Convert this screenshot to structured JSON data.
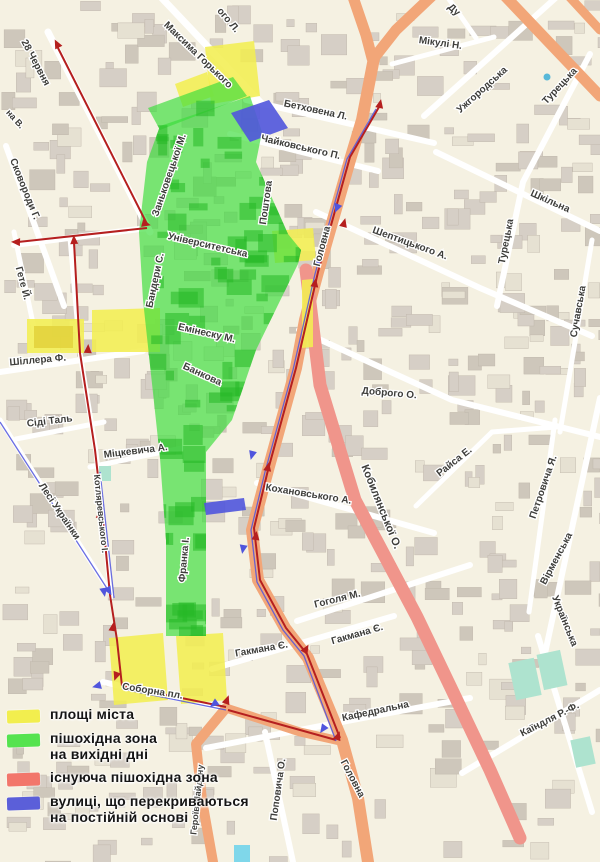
{
  "legend": {
    "items": [
      {
        "id": "city-squares",
        "color": "#f2ee4e",
        "lines": [
          "площі міста",
          ""
        ]
      },
      {
        "id": "weekend-pedestrian-zone",
        "color": "#55e34f",
        "lines": [
          "пішохідна зона",
          "на вихідні дні"
        ]
      },
      {
        "id": "existing-pedestrian-zone",
        "color": "#f2766b",
        "lines": [
          "існуюча пішохідна зона",
          ""
        ]
      },
      {
        "id": "permanently-closed-streets",
        "color": "#5b5fd9",
        "lines": [
          "вулиці, що перекриваються",
          "на постійній основі"
        ]
      }
    ]
  },
  "map": {
    "colors": {
      "background": "#f5f1e2",
      "building": "#d6cfc6",
      "green_zone": "#3ddd3d",
      "yellow_square": "#f2ee52",
      "existing_pedestrian": "#f0958b",
      "major_road": "#f2a678",
      "closed_street_blue": "#5055dd",
      "route_line_red": "#b51f1f",
      "park": "#aee3cf",
      "water": "#7fd7ea"
    },
    "street_labels": [
      {
        "text": "28 Червня",
        "x": 33,
        "y": 64,
        "rot": 62,
        "size": 10
      },
      {
        "text": "на В.",
        "x": 13,
        "y": 121,
        "rot": 48,
        "size": 9
      },
      {
        "text": "Сковороди Г.",
        "x": 22,
        "y": 190,
        "rot": 68,
        "size": 10
      },
      {
        "text": "ого Л.",
        "x": 226,
        "y": 22,
        "rot": 50,
        "size": 10
      },
      {
        "text": "Максима Горького",
        "x": 196,
        "y": 57,
        "rot": 44,
        "size": 10
      },
      {
        "text": "Ду",
        "x": 452,
        "y": 12,
        "rot": 42,
        "size": 10
      },
      {
        "text": "Мікулі Н.",
        "x": 440,
        "y": 46,
        "rot": 8,
        "size": 10
      },
      {
        "text": "Ужгородська",
        "x": 484,
        "y": 92,
        "rot": -42,
        "size": 10
      },
      {
        "text": "Турецька",
        "x": 562,
        "y": 88,
        "rot": -47,
        "size": 10
      },
      {
        "text": "Турецька",
        "x": 509,
        "y": 242,
        "rot": -79,
        "size": 10
      },
      {
        "text": "Шкільна",
        "x": 549,
        "y": 204,
        "rot": 24,
        "size": 10
      },
      {
        "text": "Сучавська",
        "x": 581,
        "y": 312,
        "rot": -80,
        "size": 10
      },
      {
        "text": "Бетховена Л.",
        "x": 315,
        "y": 113,
        "rot": 12,
        "size": 10
      },
      {
        "text": "Чайковського П.",
        "x": 300,
        "y": 150,
        "rot": 13,
        "size": 10
      },
      {
        "text": "Шептицького А.",
        "x": 409,
        "y": 246,
        "rot": 20,
        "size": 10
      },
      {
        "text": "Доброго О.",
        "x": 389,
        "y": 396,
        "rot": 5,
        "size": 10
      },
      {
        "text": "Заньковецької М.",
        "x": 172,
        "y": 176,
        "rot": -71,
        "size": 10
      },
      {
        "text": "Поштова",
        "x": 269,
        "y": 203,
        "rot": -82,
        "size": 10
      },
      {
        "text": "Університетська",
        "x": 207,
        "y": 248,
        "rot": 13,
        "size": 10
      },
      {
        "text": "Бандери С.",
        "x": 158,
        "y": 281,
        "rot": -78,
        "size": 10
      },
      {
        "text": "Емінеску М.",
        "x": 206,
        "y": 336,
        "rot": 13,
        "size": 10
      },
      {
        "text": "Банкова",
        "x": 201,
        "y": 377,
        "rot": 25,
        "size": 10
      },
      {
        "text": "Гете Й.",
        "x": 20,
        "y": 284,
        "rot": 75,
        "size": 10
      },
      {
        "text": "Шіллера Ф.",
        "x": 38,
        "y": 363,
        "rot": -5,
        "size": 10
      },
      {
        "text": "Сіді Таль",
        "x": 50,
        "y": 424,
        "rot": -7,
        "size": 10
      },
      {
        "text": "Міцкевича А.",
        "x": 136,
        "y": 454,
        "rot": -7,
        "size": 10
      },
      {
        "text": "Лесі Українки",
        "x": 57,
        "y": 513,
        "rot": 56,
        "size": 10
      },
      {
        "text": "Котляревського І.",
        "x": 98,
        "y": 514,
        "rot": 84,
        "size": 9
      },
      {
        "text": "Франка І.",
        "x": 187,
        "y": 560,
        "rot": -85,
        "size": 10
      },
      {
        "text": "Кохановського А.",
        "x": 308,
        "y": 497,
        "rot": 9,
        "size": 10
      },
      {
        "text": "Кобилянської О.",
        "x": 378,
        "y": 508,
        "rot": 68,
        "size": 11
      },
      {
        "text": "Головна",
        "x": 325,
        "y": 247,
        "rot": -75,
        "size": 10
      },
      {
        "text": "Гоголя М.",
        "x": 338,
        "y": 602,
        "rot": -14,
        "size": 10
      },
      {
        "text": "Райса Е.",
        "x": 456,
        "y": 464,
        "rot": -38,
        "size": 10
      },
      {
        "text": "Петровича Я.",
        "x": 546,
        "y": 488,
        "rot": -71,
        "size": 10
      },
      {
        "text": "Вірменська",
        "x": 559,
        "y": 560,
        "rot": -62,
        "size": 10
      },
      {
        "text": "Українська",
        "x": 562,
        "y": 622,
        "rot": 68,
        "size": 10
      },
      {
        "text": "Гакмана Є.",
        "x": 262,
        "y": 652,
        "rot": -10,
        "size": 10
      },
      {
        "text": "Гакмана Є.",
        "x": 358,
        "y": 637,
        "rot": -16,
        "size": 10
      },
      {
        "text": "Соборна пл.",
        "x": 152,
        "y": 694,
        "rot": 9,
        "size": 10
      },
      {
        "text": "Кафедральна",
        "x": 376,
        "y": 714,
        "rot": -12,
        "size": 10
      },
      {
        "text": "Каїндля Р.-Ф.",
        "x": 551,
        "y": 722,
        "rot": -27,
        "size": 10
      },
      {
        "text": "Головна",
        "x": 350,
        "y": 780,
        "rot": 62,
        "size": 10
      },
      {
        "text": "Героїв Майдану",
        "x": 200,
        "y": 800,
        "rot": -84,
        "size": 9
      },
      {
        "text": "Поповича О.",
        "x": 281,
        "y": 790,
        "rot": -82,
        "size": 10
      }
    ]
  }
}
